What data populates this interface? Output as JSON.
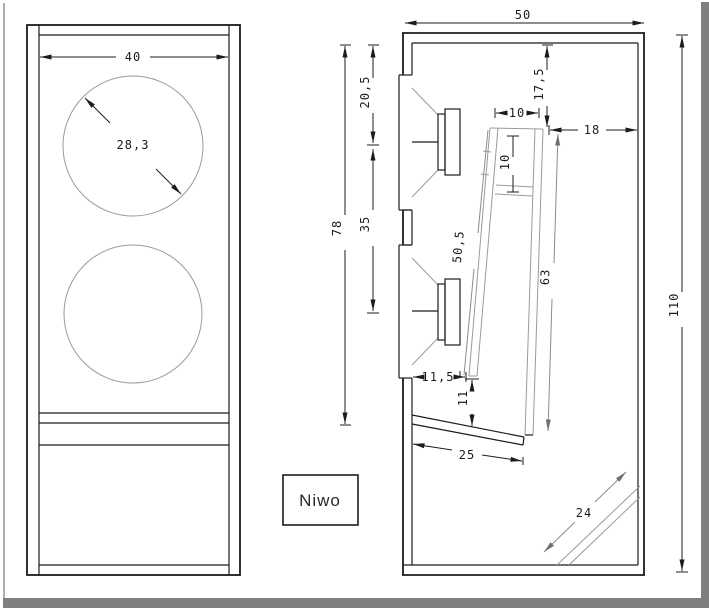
{
  "drawing": {
    "label_box": {
      "text": "Niwo"
    },
    "front_view": {
      "width_dim": "40",
      "diameter_dim": "28,3"
    },
    "side_view": {
      "depth_dim": "50",
      "top_to_driver1_dim": "20,5",
      "driver1_to_driver2_dim": "35",
      "top_to_channel_bottom_dim": "78",
      "top_to_port_dim": "17,5",
      "port_width_dim": "10",
      "port_to_back_dim": "18",
      "port_depth_dim": "10",
      "channel_front_length_dim": "50,5",
      "channel_back_length_dim": "63",
      "total_height_dim": "110",
      "wall_to_channel_dim": "11,5",
      "channel_bottom_gap_dim": "11",
      "shelf_dim": "25",
      "corner_port_dim": "24"
    },
    "colors": {
      "line_black": "#1c1c1c",
      "line_gray": "#9a9a9a",
      "frame_gray": "#7f7f7f",
      "background": "#ffffff"
    }
  }
}
